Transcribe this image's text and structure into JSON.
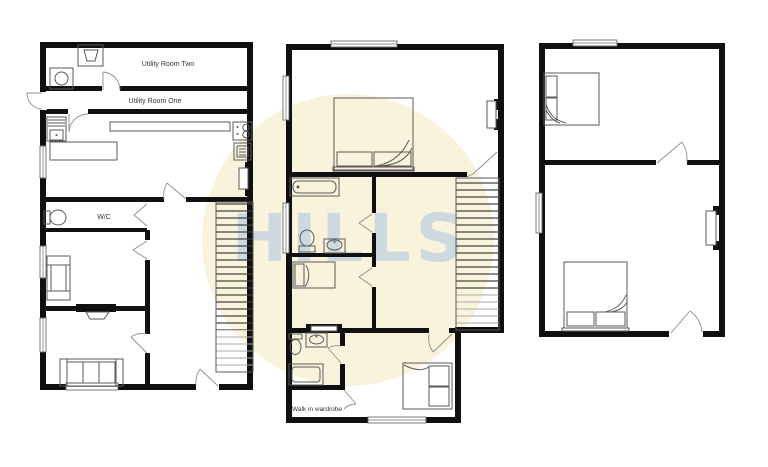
{
  "watermark": {
    "text": "HILLS",
    "circle_color": "#FAF3DC",
    "text_color": "#C6D5DF"
  },
  "plans": {
    "ground_floor": {
      "labels": {
        "utility_room_two": "Utility Room Two",
        "utility_room_one": "Utility Room One",
        "wc": "W/C"
      }
    },
    "first_floor": {
      "labels": {
        "walk_in_wardrobe": "Walk in wardrobe"
      }
    }
  },
  "colors": {
    "wall": "#101010",
    "furniture_line": "#5a5a5a",
    "label_text": "#333333"
  }
}
